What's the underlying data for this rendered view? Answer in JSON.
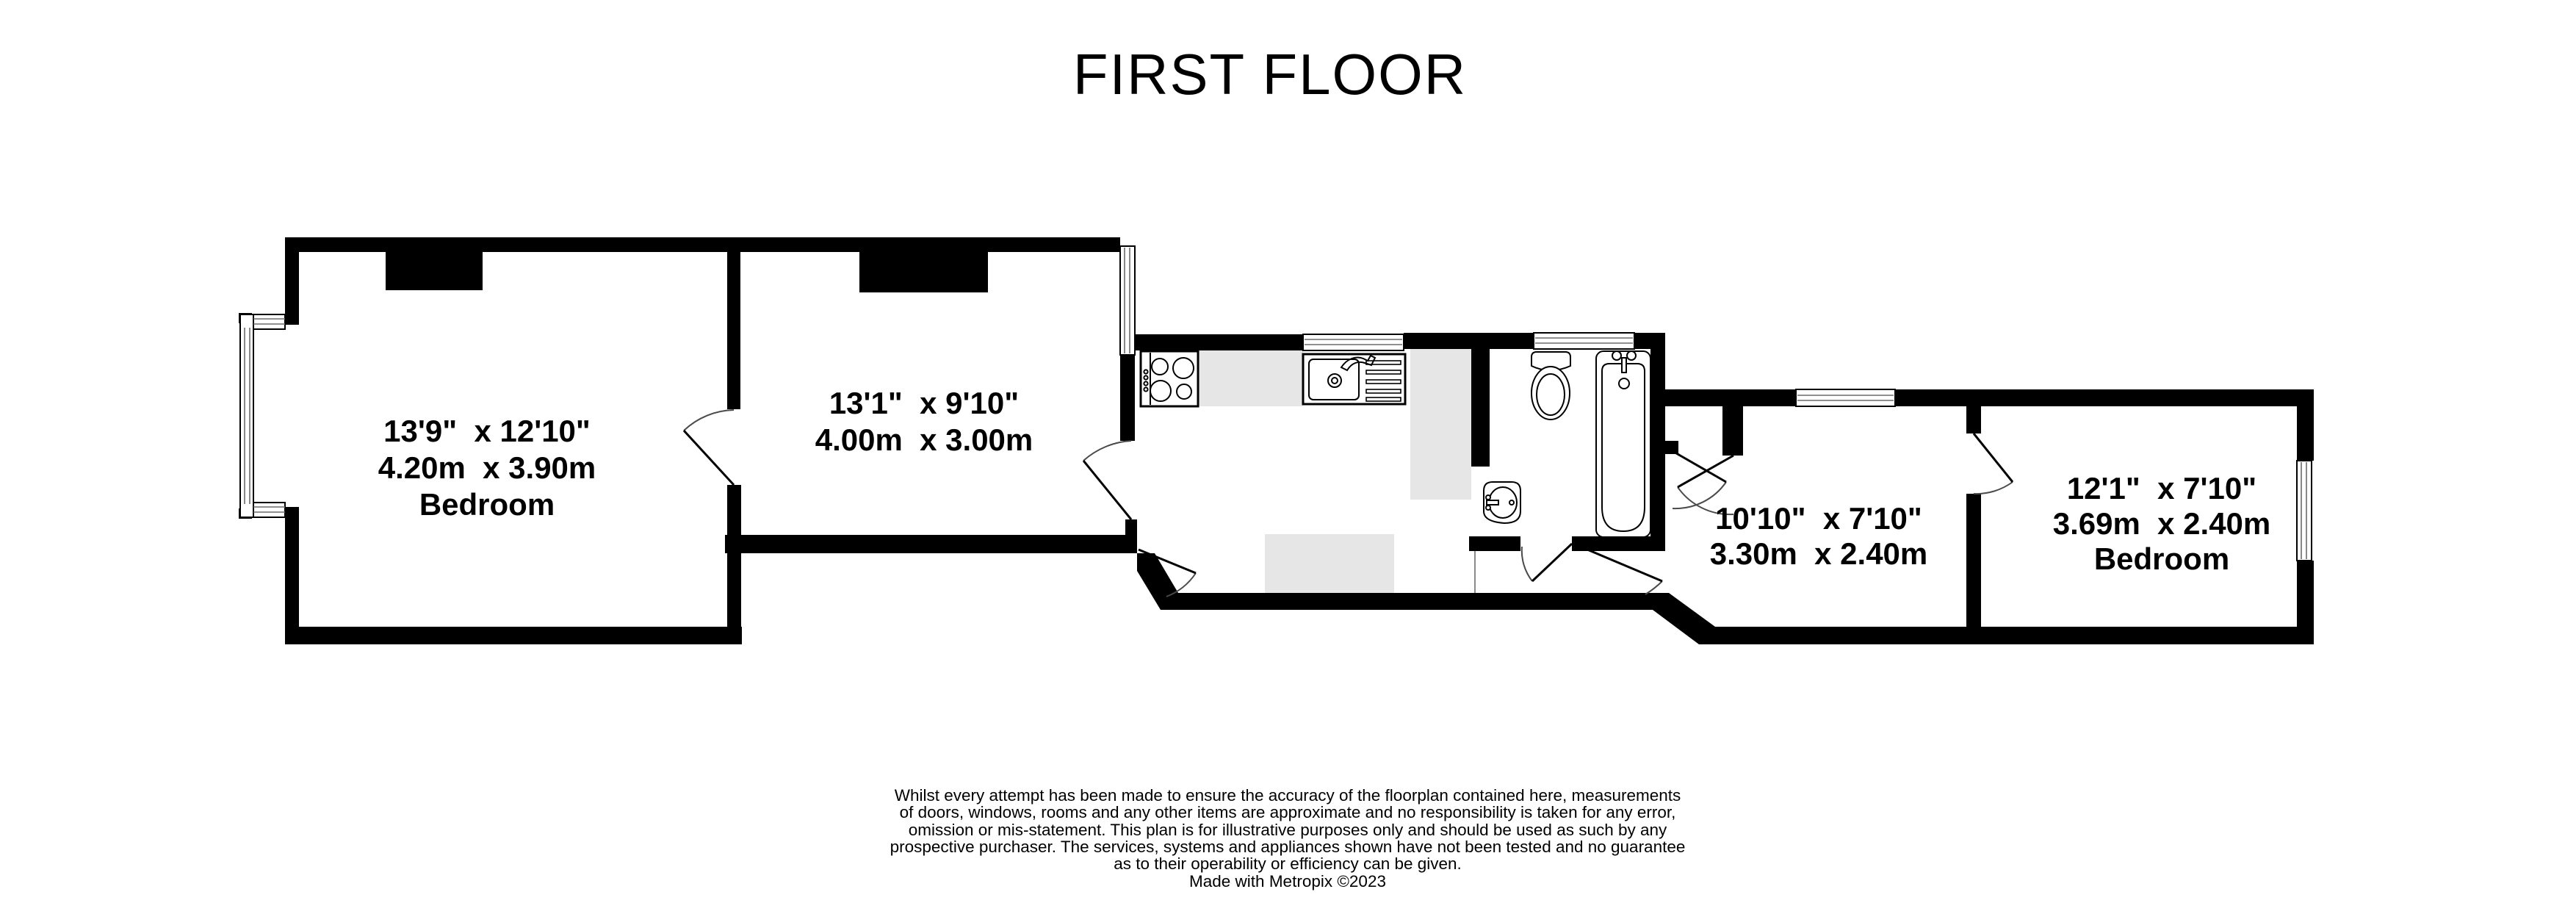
{
  "title": "FIRST FLOOR",
  "colors": {
    "wall": "#000000",
    "floor": "#ffffff",
    "counter_gray": "#e6e6e6",
    "door_arc": "#4a4a4a",
    "text": "#000000"
  },
  "rooms": [
    {
      "name": "bedroom-1",
      "dims_imperial": "13'9\"  x 12'10\"",
      "dims_metric": "4.20m  x 3.90m",
      "label": "Bedroom"
    },
    {
      "name": "reception-room",
      "dims_imperial": "13'1\"  x 9'10\"",
      "dims_metric": "4.00m  x 3.00m",
      "label": ""
    },
    {
      "name": "room-3",
      "dims_imperial": "10'10\"  x 7'10\"",
      "dims_metric": "3.30m  x 2.40m",
      "label": ""
    },
    {
      "name": "bedroom-2",
      "dims_imperial": "12'1\"  x 7'10\"",
      "dims_metric": "3.69m  x 2.40m",
      "label": "Bedroom"
    }
  ],
  "fixtures": [
    {
      "icon": "hob-icon"
    },
    {
      "icon": "sink-drainer-icon"
    },
    {
      "icon": "toilet-icon"
    },
    {
      "icon": "bath-icon"
    },
    {
      "icon": "basin-icon"
    }
  ],
  "disclaimer": {
    "lines": [
      "Whilst every attempt has been made to ensure the accuracy of the floorplan contained here, measurements",
      "of doors, windows, rooms and any other items are approximate and no responsibility is taken for any error,",
      "omission or mis-statement. This plan is for illustrative purposes only and should be used as such by any",
      "prospective purchaser. The services, systems and appliances shown have not been tested and no guarantee",
      "as to their operability or efficiency can be given.",
      "Made with Metropix ©2023"
    ]
  }
}
